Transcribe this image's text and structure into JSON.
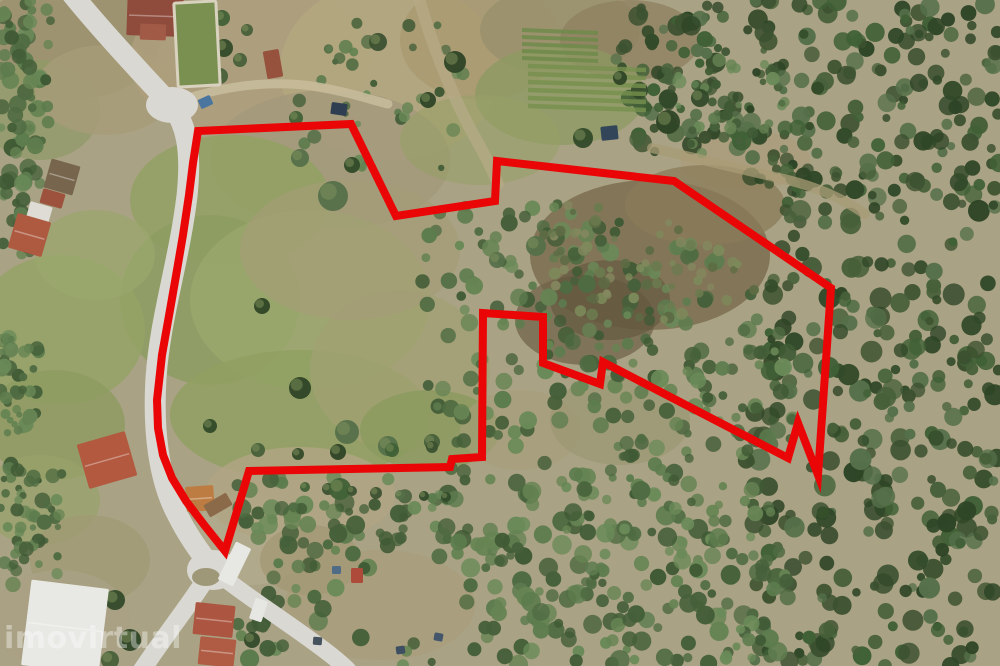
{
  "scene": {
    "type": "aerial-photograph",
    "description": "Drone aerial view of a rural land parcel (fields on the left, dense forest on the right) with the property boundary outlined in red; a country road runs along the left edge of the plot with farm buildings beside it",
    "width": 1000,
    "height": 666
  },
  "watermark": {
    "text": "imovirtual",
    "color": "#ffffff",
    "opacity": 0.38
  },
  "boundary": {
    "color": "#ea0606",
    "stroke_width": 8,
    "points": "198,131 351,124 396,216 495,201 497,161 674,181 831,288 818,475 798,423 788,458 603,362 600,384 543,363 543,317 483,313 482,457 452,459 450,467 249,471 225,551 205,526 186,501 172,478 163,455 158,428 157,400 162,355 170,310 177,270 183,235 189,195 193,163"
  },
  "palette": {
    "field_tan": "#a9a284",
    "meadow_green": "#8fa061",
    "forest_dark": "#3c5130",
    "forest_mid": "#55744a",
    "scrub_brown": "#7d6f50",
    "road_gray": "#d9d8d2",
    "track_tan": "#c6bb9b",
    "roof_terracotta": "#ad5a41",
    "roof_white": "#e8e9e4"
  },
  "features": [
    {
      "name": "house-top-left",
      "x": 127,
      "y": -4,
      "w": 56,
      "h": 40,
      "rot": 2,
      "fill": "#8f4b3c"
    },
    {
      "name": "house-top-left-wing",
      "x": 140,
      "y": 24,
      "w": 26,
      "h": 16,
      "rot": 2,
      "fill": "#a15a46"
    },
    {
      "name": "walled-garden",
      "x": 176,
      "y": 2,
      "w": 42,
      "h": 84,
      "rot": -3,
      "fill": "#7a9050",
      "stroke": "#d8d2bf"
    },
    {
      "name": "shed-red-roof",
      "x": 265,
      "y": 50,
      "w": 16,
      "h": 28,
      "rot": -10,
      "fill": "#96523d"
    },
    {
      "name": "barn-ruin",
      "x": 47,
      "y": 162,
      "w": 30,
      "h": 30,
      "rot": 16,
      "fill": "#77664d"
    },
    {
      "name": "barn-red-roof",
      "x": 41,
      "y": 191,
      "w": 23,
      "h": 15,
      "rot": 16,
      "fill": "#9c523c"
    },
    {
      "name": "barn-white-roof",
      "x": 28,
      "y": 204,
      "w": 23,
      "h": 16,
      "rot": 16,
      "fill": "#dedcd4"
    },
    {
      "name": "farmhouse-red-roof",
      "x": 12,
      "y": 217,
      "w": 35,
      "h": 36,
      "rot": 16,
      "fill": "#ad5a41"
    },
    {
      "name": "house-left-red-roof",
      "x": 82,
      "y": 437,
      "w": 50,
      "h": 46,
      "rot": -16,
      "fill": "#b25940"
    },
    {
      "name": "warehouse-white-roof",
      "x": 26,
      "y": 584,
      "w": 78,
      "h": 86,
      "rot": 7,
      "fill": "#e8e9e4"
    },
    {
      "name": "house-bottom-red-roof-1",
      "x": 194,
      "y": 604,
      "w": 40,
      "h": 32,
      "rot": 6,
      "fill": "#ac5540"
    },
    {
      "name": "house-bottom-red-roof-2",
      "x": 199,
      "y": 638,
      "w": 36,
      "h": 28,
      "rot": 6,
      "fill": "#b05c44"
    },
    {
      "name": "van-white",
      "x": 252,
      "y": 599,
      "w": 13,
      "h": 22,
      "rot": 18,
      "fill": "#e6e6e2"
    },
    {
      "name": "excavator-orange",
      "x": 186,
      "y": 486,
      "w": 28,
      "h": 25,
      "rot": -4,
      "fill": "#bd7c42"
    },
    {
      "name": "log-pile",
      "x": 205,
      "y": 498,
      "w": 26,
      "h": 14,
      "rot": -30,
      "fill": "#8a6a48"
    },
    {
      "name": "truck-white",
      "x": 226,
      "y": 543,
      "w": 17,
      "h": 42,
      "rot": 26,
      "fill": "#e7e7e3"
    },
    {
      "name": "car-blue",
      "x": 199,
      "y": 97,
      "w": 13,
      "h": 10,
      "rot": -24,
      "fill": "#49759f"
    },
    {
      "name": "car-dark",
      "x": 331,
      "y": 103,
      "w": 16,
      "h": 12,
      "rot": 8,
      "fill": "#2f3e50"
    },
    {
      "name": "pickup-dark",
      "x": 601,
      "y": 126,
      "w": 17,
      "h": 14,
      "rot": -6,
      "fill": "#334659"
    },
    {
      "name": "tarp-red",
      "x": 351,
      "y": 568,
      "w": 12,
      "h": 15,
      "rot": 0,
      "fill": "#ae4a3a"
    },
    {
      "name": "beehive-1",
      "x": 332,
      "y": 566,
      "w": 9,
      "h": 8,
      "rot": 0,
      "fill": "#4f6b86"
    },
    {
      "name": "beehive-2",
      "x": 434,
      "y": 633,
      "w": 9,
      "h": 8,
      "rot": 10,
      "fill": "#44566b"
    },
    {
      "name": "beehive-3",
      "x": 396,
      "y": 646,
      "w": 9,
      "h": 8,
      "rot": -8,
      "fill": "#3e4f62"
    },
    {
      "name": "beehive-4",
      "x": 313,
      "y": 637,
      "w": 9,
      "h": 8,
      "rot": 5,
      "fill": "#46525e"
    }
  ]
}
